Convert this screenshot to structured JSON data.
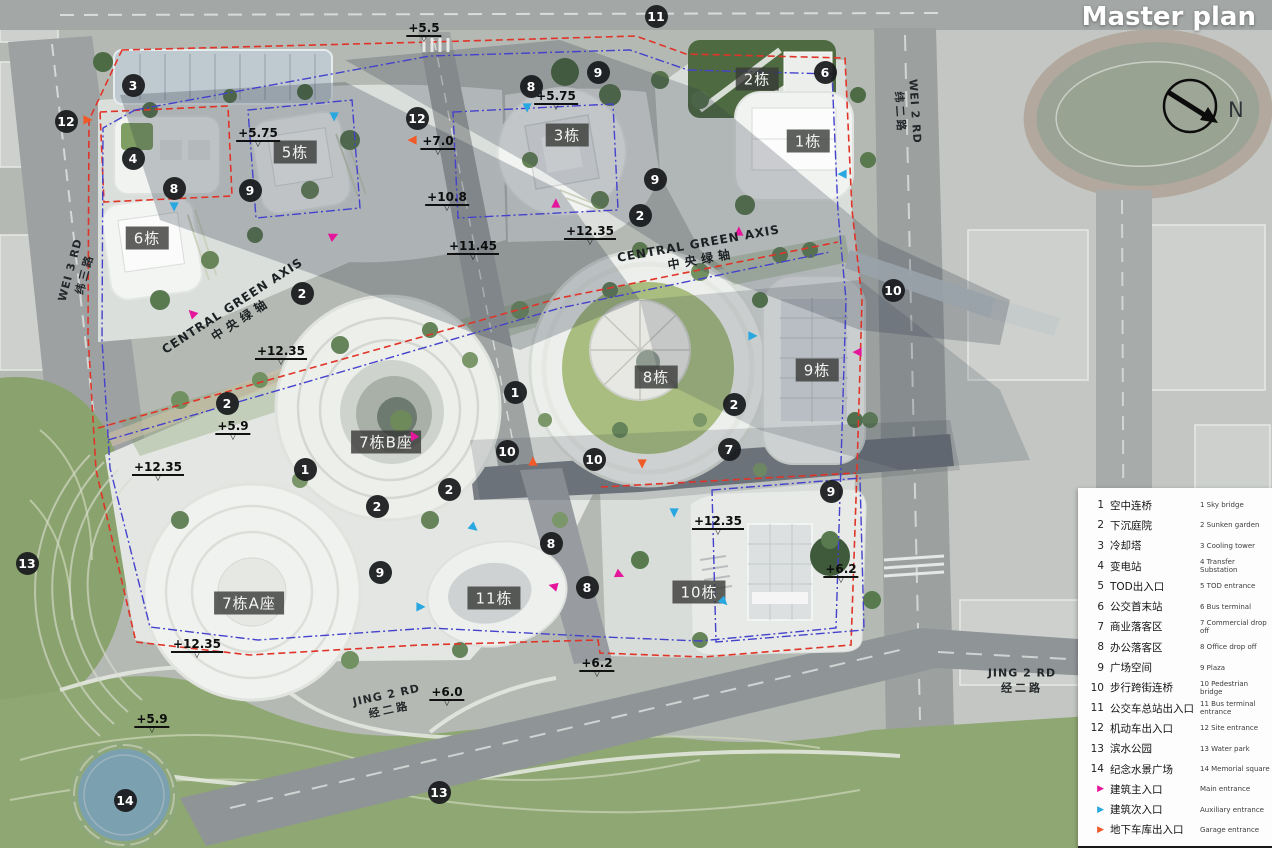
{
  "title": "Master plan",
  "north_label": "N",
  "colors": {
    "main": "#e5169b",
    "aux": "#29a7e0",
    "garage": "#f05a28",
    "boundary_red": "#e03428",
    "boundary_blue": "#4442cc",
    "marker_bg": "#1d1f21"
  },
  "legend": {
    "items": [
      {
        "num": "1",
        "zh": "空中连桥",
        "en": "1 Sky bridge"
      },
      {
        "num": "2",
        "zh": "下沉庭院",
        "en": "2 Sunken garden"
      },
      {
        "num": "3",
        "zh": "冷却塔",
        "en": "3 Cooling tower"
      },
      {
        "num": "4",
        "zh": "变电站",
        "en": "4 Transfer Substation"
      },
      {
        "num": "5",
        "zh": "TOD出入口",
        "en": "5 TOD entrance"
      },
      {
        "num": "6",
        "zh": "公交首末站",
        "en": "6 Bus terminal"
      },
      {
        "num": "7",
        "zh": "商业落客区",
        "en": "7 Commercial drop off"
      },
      {
        "num": "8",
        "zh": "办公落客区",
        "en": "8 Office drop off"
      },
      {
        "num": "9",
        "zh": "广场空间",
        "en": "9 Plaza"
      },
      {
        "num": "10",
        "zh": "步行跨街连桥",
        "en": "10 Pedestrian bridge"
      },
      {
        "num": "11",
        "zh": "公交车总站出入口",
        "en": "11 Bus terminal entrance"
      },
      {
        "num": "12",
        "zh": "机动车出入口",
        "en": "12 Site entrance"
      },
      {
        "num": "13",
        "zh": "滨水公园",
        "en": "13 Water park"
      },
      {
        "num": "14",
        "zh": "纪念水景广场",
        "en": "14 Memorial square"
      }
    ],
    "entrance_items": [
      {
        "type": "main",
        "zh": "建筑主入口",
        "en": "Main entrance"
      },
      {
        "type": "aux",
        "zh": "建筑次入口",
        "en": "Auxiliary entrance"
      },
      {
        "type": "garage",
        "zh": "地下车库出入口",
        "en": "Garage entrance"
      }
    ]
  },
  "map": {
    "buildings": [
      {
        "label": "2栋",
        "x": 757,
        "y": 79
      },
      {
        "label": "1栋",
        "x": 808,
        "y": 141
      },
      {
        "label": "3栋",
        "x": 567,
        "y": 135
      },
      {
        "label": "5栋",
        "x": 295,
        "y": 152
      },
      {
        "label": "6栋",
        "x": 147,
        "y": 238
      },
      {
        "label": "8栋",
        "x": 656,
        "y": 377
      },
      {
        "label": "9栋",
        "x": 817,
        "y": 370
      },
      {
        "label": "7栋B座",
        "x": 386,
        "y": 442
      },
      {
        "label": "7栋A座",
        "x": 249,
        "y": 603
      },
      {
        "label": "11栋",
        "x": 494,
        "y": 598
      },
      {
        "label": "10栋",
        "x": 699,
        "y": 592
      }
    ],
    "markers": [
      {
        "n": "11",
        "x": 656,
        "y": 16
      },
      {
        "n": "3",
        "x": 133,
        "y": 85
      },
      {
        "n": "8",
        "x": 531,
        "y": 86
      },
      {
        "n": "9",
        "x": 598,
        "y": 72
      },
      {
        "n": "6",
        "x": 825,
        "y": 72
      },
      {
        "n": "12",
        "x": 66,
        "y": 121
      },
      {
        "n": "12",
        "x": 417,
        "y": 118
      },
      {
        "n": "4",
        "x": 133,
        "y": 158
      },
      {
        "n": "8",
        "x": 174,
        "y": 188
      },
      {
        "n": "9",
        "x": 250,
        "y": 190
      },
      {
        "n": "9",
        "x": 655,
        "y": 179
      },
      {
        "n": "2",
        "x": 640,
        "y": 215
      },
      {
        "n": "10",
        "x": 893,
        "y": 290
      },
      {
        "n": "2",
        "x": 302,
        "y": 293
      },
      {
        "n": "2",
        "x": 227,
        "y": 403
      },
      {
        "n": "1",
        "x": 515,
        "y": 392
      },
      {
        "n": "2",
        "x": 734,
        "y": 404
      },
      {
        "n": "7",
        "x": 729,
        "y": 449
      },
      {
        "n": "10",
        "x": 507,
        "y": 451
      },
      {
        "n": "10",
        "x": 594,
        "y": 459
      },
      {
        "n": "1",
        "x": 305,
        "y": 469
      },
      {
        "n": "2",
        "x": 449,
        "y": 489
      },
      {
        "n": "9",
        "x": 831,
        "y": 491
      },
      {
        "n": "2",
        "x": 377,
        "y": 506
      },
      {
        "n": "8",
        "x": 551,
        "y": 543
      },
      {
        "n": "13",
        "x": 27,
        "y": 563
      },
      {
        "n": "9",
        "x": 380,
        "y": 572
      },
      {
        "n": "8",
        "x": 587,
        "y": 587
      },
      {
        "n": "13",
        "x": 439,
        "y": 792
      },
      {
        "n": "14",
        "x": 125,
        "y": 800
      }
    ],
    "elevations": [
      {
        "v": "+5.5",
        "x": 424,
        "y": 22
      },
      {
        "v": "+5.75",
        "x": 556,
        "y": 90
      },
      {
        "v": "+5.75",
        "x": 258,
        "y": 127
      },
      {
        "v": "+7.0",
        "x": 438,
        "y": 135
      },
      {
        "v": "+10.8",
        "x": 447,
        "y": 191
      },
      {
        "v": "+12.35",
        "x": 590,
        "y": 225
      },
      {
        "v": "+11.45",
        "x": 473,
        "y": 240
      },
      {
        "v": "+12.35",
        "x": 281,
        "y": 345
      },
      {
        "v": "+5.9",
        "x": 233,
        "y": 420
      },
      {
        "v": "+12.35",
        "x": 158,
        "y": 461
      },
      {
        "v": "+12.35",
        "x": 718,
        "y": 515
      },
      {
        "v": "+6.2",
        "x": 841,
        "y": 563
      },
      {
        "v": "+12.35",
        "x": 197,
        "y": 638
      },
      {
        "v": "+6.2",
        "x": 597,
        "y": 657
      },
      {
        "v": "+6.0",
        "x": 447,
        "y": 686
      },
      {
        "v": "+5.9",
        "x": 152,
        "y": 713
      }
    ],
    "entrances": [
      {
        "t": "main",
        "x": 334,
        "y": 236,
        "r": -25
      },
      {
        "t": "main",
        "x": 556,
        "y": 203,
        "r": -90
      },
      {
        "t": "main",
        "x": 739,
        "y": 231,
        "r": -90
      },
      {
        "t": "main",
        "x": 413,
        "y": 435,
        "r": -120
      },
      {
        "t": "main",
        "x": 192,
        "y": 313,
        "r": -135
      },
      {
        "t": "main",
        "x": 857,
        "y": 352,
        "r": 180
      },
      {
        "t": "main",
        "x": 553,
        "y": 586,
        "r": 195
      },
      {
        "t": "main",
        "x": 620,
        "y": 575,
        "r": 25
      },
      {
        "t": "aux",
        "x": 334,
        "y": 117,
        "r": 90
      },
      {
        "t": "aux",
        "x": 527,
        "y": 108,
        "r": 90
      },
      {
        "t": "aux",
        "x": 174,
        "y": 207,
        "r": 90
      },
      {
        "t": "aux",
        "x": 842,
        "y": 174,
        "r": 180
      },
      {
        "t": "aux",
        "x": 753,
        "y": 336,
        "r": 0
      },
      {
        "t": "aux",
        "x": 674,
        "y": 513,
        "r": 90
      },
      {
        "t": "aux",
        "x": 474,
        "y": 528,
        "r": 40
      },
      {
        "t": "aux",
        "x": 421,
        "y": 607,
        "r": 0
      },
      {
        "t": "aux",
        "x": 724,
        "y": 602,
        "r": 45
      },
      {
        "t": "garage",
        "x": 88,
        "y": 120,
        "r": 0
      },
      {
        "t": "garage",
        "x": 412,
        "y": 140,
        "r": 180
      },
      {
        "t": "garage",
        "x": 533,
        "y": 461,
        "r": -90
      },
      {
        "t": "garage",
        "x": 642,
        "y": 464,
        "r": 90
      }
    ],
    "roads": [
      {
        "en": "WEI 3 RD",
        "zh": "纬三路",
        "x": 78,
        "y": 272,
        "rot": -75
      },
      {
        "en": "WEI 2 RD",
        "zh": "纬二路",
        "x": 907,
        "y": 112,
        "rot": 86
      },
      {
        "en": "JING 2 RD",
        "zh": "经二路",
        "x": 388,
        "y": 703,
        "rot": -12
      },
      {
        "en": "JING 2 RD",
        "zh": "经二路",
        "x": 1022,
        "y": 681,
        "rot": 0
      }
    ],
    "axes": [
      {
        "en": "CENTRAL GREEN AXIS",
        "zh": "中央绿轴",
        "x": 237,
        "y": 313,
        "rot": -33
      },
      {
        "en": "CENTRAL GREEN AXIS",
        "zh": "中央绿轴",
        "x": 700,
        "y": 252,
        "rot": -10
      }
    ]
  }
}
